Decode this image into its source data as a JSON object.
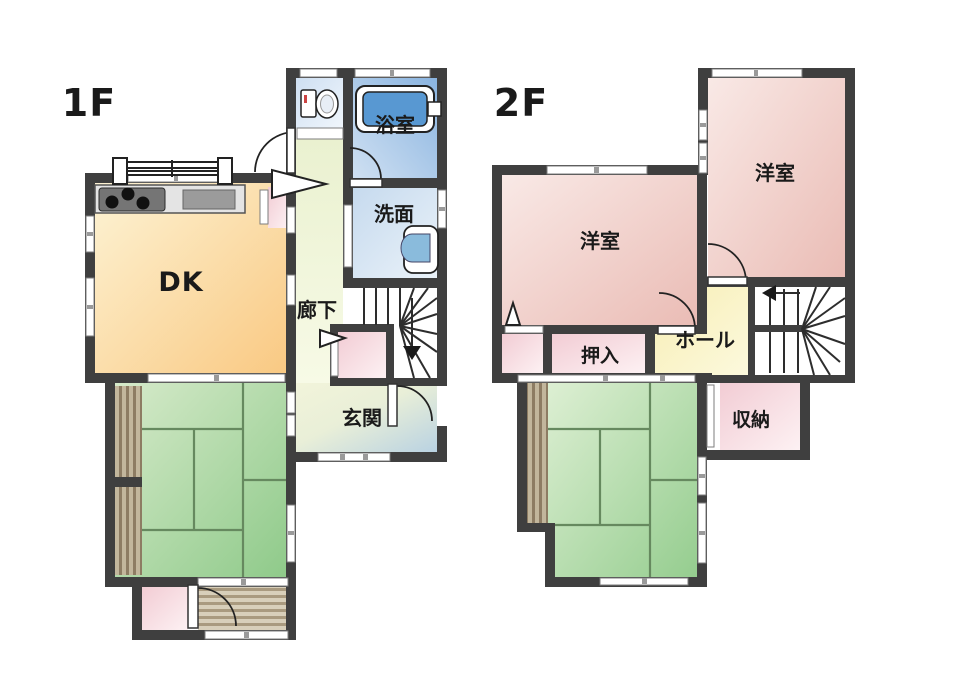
{
  "title": "Japanese house floor plan, 1F and 2F",
  "colors": {
    "wall": "#3f3f3f",
    "text": "#1a1a1a",
    "dk_light": "#fdf3d4",
    "dk_dark": "#f9c983",
    "tatami_light": "#d6eaca",
    "tatami_dark": "#8fca8a",
    "bedroom_light": "#f9e9e6",
    "bedroom_dark": "#eabcb5",
    "closet_light": "#fdf1f3",
    "closet_dark": "#f2ccd4",
    "bath_light": "#cfe0f2",
    "bath_dark": "#8ab4e0",
    "toilet_light": "#f0f6fc",
    "toilet_dark": "#cedff2",
    "wash_light": "#eaf2f9",
    "wash_dark": "#c6daee",
    "corridor_light": "#f7fae6",
    "corridor_dark": "#eaf1d0",
    "entrance_light": "#f2f4da",
    "entrance_dark": "#b9d2e2",
    "hall_light": "#fcf9dd",
    "hall_dark": "#f7eeb5",
    "wood_dark": "#8d7c63",
    "wood_light": "#c2b69c",
    "tub_fill": "#5898d2",
    "basin_fill": "#8abbdc"
  },
  "floor1": {
    "label": "1F",
    "rooms": {
      "dk": "DK",
      "corridor": "廊下",
      "bath": "浴室",
      "washroom": "洗面",
      "entrance": "玄関"
    }
  },
  "floor2": {
    "label": "2F",
    "rooms": {
      "bedroom_right": "洋室",
      "bedroom_left": "洋室",
      "closet": "押入",
      "hall": "ホール",
      "storage": "収納"
    }
  }
}
